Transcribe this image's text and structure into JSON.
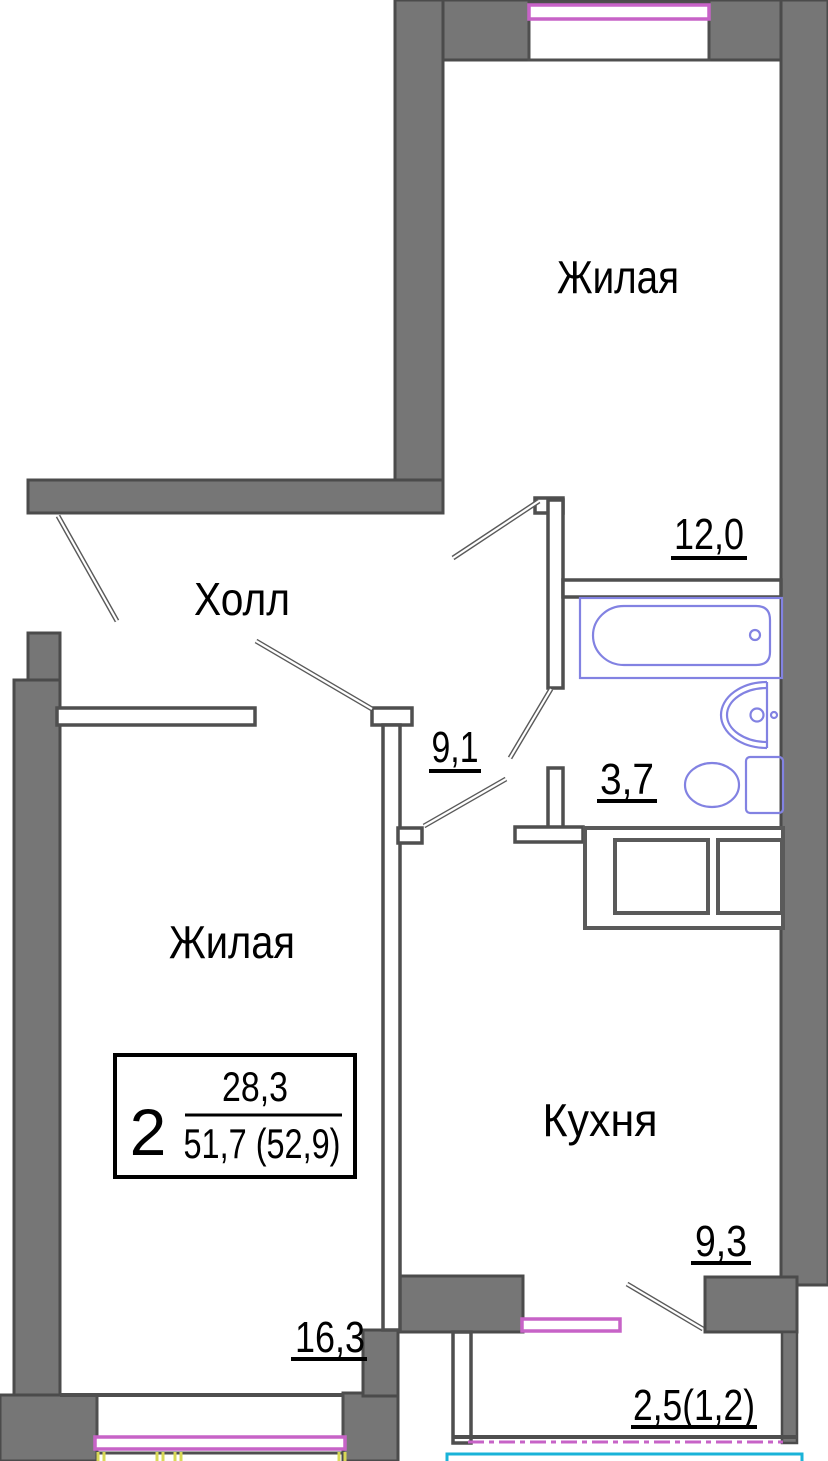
{
  "plan": {
    "kind": "apartment-floor-plan",
    "rooms": [
      {
        "name": "living-top",
        "label": "Жилая",
        "area": "12,0"
      },
      {
        "name": "hall",
        "label": "Холл",
        "area": "9,1"
      },
      {
        "name": "bathroom",
        "label": "",
        "area": "3,7"
      },
      {
        "name": "living-left",
        "label": "Жилая",
        "area": "16,3"
      },
      {
        "name": "kitchen",
        "label": "Кухня",
        "area": "9,3"
      },
      {
        "name": "balcony",
        "label": "",
        "area": "2,5(1,2)"
      }
    ],
    "stamp": {
      "rooms_count": "2",
      "living_area": "28,3",
      "total_area": "51,7 (52,9)"
    },
    "colors": {
      "wall_fill": "#767676",
      "wall_outline": "#4b4b4b",
      "window_frame": "#c763c7",
      "fixtures": "#8282e2",
      "balcony_glazing": "#1ab3d8",
      "dimension_ticks": "#d8d855"
    }
  }
}
